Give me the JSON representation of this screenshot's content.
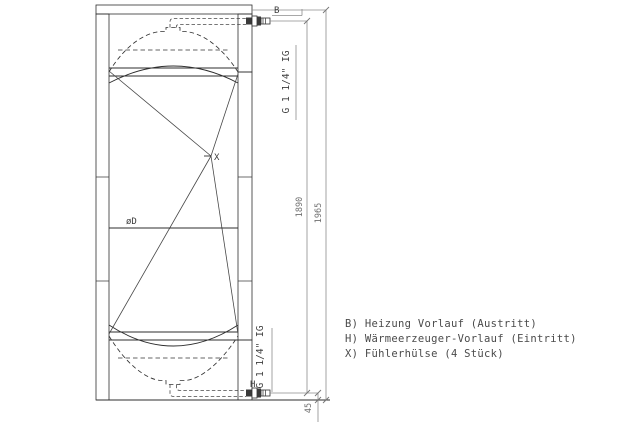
{
  "drawing": {
    "labels": {
      "port_top": "B",
      "port_bottom": "H",
      "sensor": "X",
      "diameter": "øD",
      "thread_top": "G 1 1/4\" IG",
      "thread_bottom": "G 1 1/4\" IG"
    },
    "dimensions": {
      "port_span": "1890",
      "total_height": "1965",
      "bottom_offset": "45"
    }
  },
  "legend": {
    "items": [
      "B) Heizung Vorlauf (Austritt)",
      "H) Wärmeerzeuger-Vorlauf (Eintritt)",
      "X) Fühlerhülse (4 Stück)"
    ]
  },
  "colors": {
    "background": "#ffffff",
    "line_main": "#2e2e2e",
    "line_dimension": "#8c8c8c",
    "text": "#4a4a4a"
  }
}
